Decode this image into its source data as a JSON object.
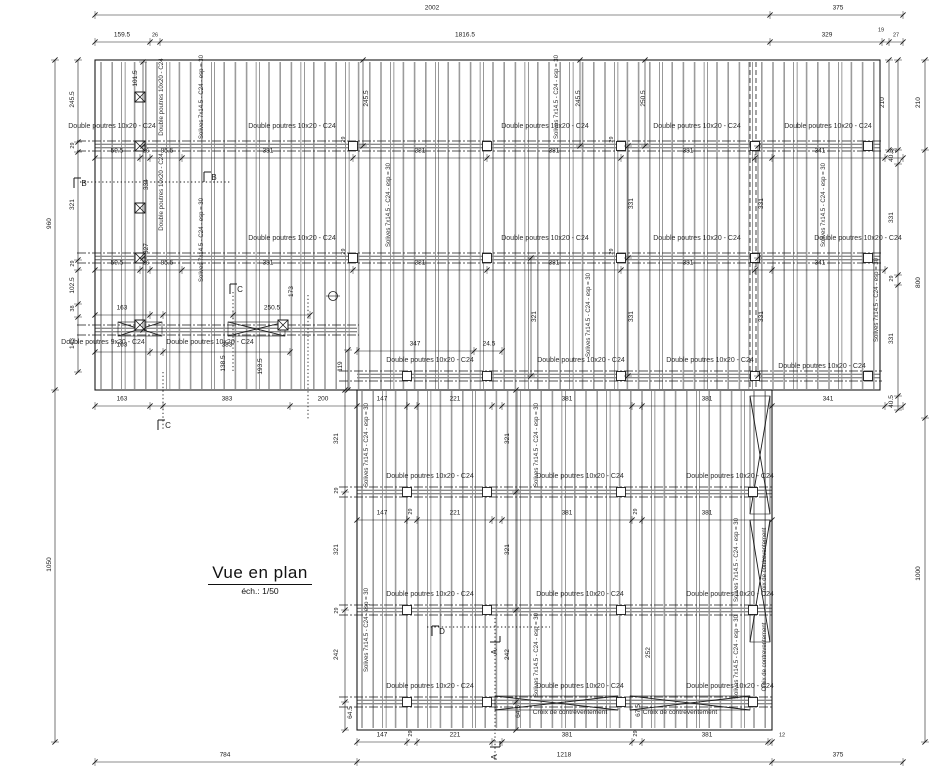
{
  "title": {
    "text": "Vue en plan",
    "scale_note": "éch.: 1/50"
  },
  "colors": {
    "line": "#1a1a1a",
    "joist": "#9c9c9c",
    "joist_dark": "#555555",
    "label": "#2e2e2e",
    "bg": "#ffffff"
  },
  "materials": {
    "double_beam_10x20": "Double poutres 10x20 - C24",
    "double_beam_9x20": "Double poutres 9x20 - C24",
    "joists": "Solives 7x14.5 - C24 - esp = 30",
    "bracing": "Croix de contreventement"
  },
  "section_markers_present": [
    "A",
    "B",
    "C",
    "D"
  ],
  "dimension_summary": {
    "top_row1": [
      "2002",
      "375"
    ],
    "top_row2": [
      "159.5",
      "26",
      "1816.5",
      "329",
      "19",
      "27"
    ],
    "bottom_row": [
      "784",
      "1218",
      "375"
    ],
    "left_outer": [
      "960",
      "1050"
    ],
    "left_inner": [
      "245.5",
      "29",
      "321",
      "29",
      "102.5",
      "38",
      "143"
    ],
    "right_outer": [
      "210",
      "800",
      "1000"
    ],
    "right_inner": [
      "210",
      "40.5",
      "331",
      "29",
      "331",
      "40.5"
    ]
  },
  "drawing": {
    "size": {
      "w": 937,
      "h": 779
    },
    "outlines": [
      [
        95,
        60,
        785,
        330
      ],
      [
        357,
        390,
        415,
        340
      ]
    ],
    "joist_fields": [
      {
        "x1": 101,
        "x2": 874,
        "y1": 62,
        "y2": 389,
        "sp": 11.2
      },
      {
        "x1": 362,
        "x2": 768,
        "y1": 391,
        "y2": 728,
        "sp": 11.2
      }
    ],
    "beam_bands": [
      {
        "y": 146,
        "x1": 95,
        "x2": 880
      },
      {
        "y": 258,
        "x1": 95,
        "x2": 880
      },
      {
        "y": 330,
        "x1": 95,
        "x2": 357
      },
      {
        "y": 376,
        "x1": 357,
        "x2": 880
      },
      {
        "y": 492,
        "x1": 357,
        "x2": 772
      },
      {
        "y": 610,
        "x1": 357,
        "x2": 772
      },
      {
        "y": 702,
        "x1": 357,
        "x2": 772
      }
    ],
    "posts": [
      [
        353,
        146
      ],
      [
        487,
        146
      ],
      [
        621,
        146
      ],
      [
        755,
        146
      ],
      [
        868,
        146
      ],
      [
        353,
        258
      ],
      [
        487,
        258
      ],
      [
        621,
        258
      ],
      [
        755,
        258
      ],
      [
        868,
        258
      ],
      [
        407,
        376
      ],
      [
        487,
        376
      ],
      [
        621,
        376
      ],
      [
        755,
        376
      ],
      [
        868,
        376
      ],
      [
        407,
        492
      ],
      [
        487,
        492
      ],
      [
        621,
        492
      ],
      [
        753,
        492
      ],
      [
        407,
        610
      ],
      [
        487,
        610
      ],
      [
        621,
        610
      ],
      [
        753,
        610
      ],
      [
        407,
        702
      ],
      [
        487,
        702
      ],
      [
        621,
        702
      ],
      [
        753,
        702
      ]
    ],
    "hatched_posts": [
      [
        140,
        97
      ],
      [
        140,
        146
      ],
      [
        140,
        208
      ],
      [
        140,
        258
      ],
      [
        140,
        325
      ],
      [
        283,
        325
      ]
    ],
    "x_braces": [
      [
        750,
        396,
        770,
        514
      ],
      [
        750,
        520,
        770,
        642
      ],
      [
        495,
        696,
        618,
        710
      ],
      [
        630,
        696,
        750,
        710
      ],
      [
        118,
        322,
        162,
        336
      ],
      [
        228,
        322,
        285,
        336
      ]
    ],
    "dashed_members": [
      [
        750,
        62,
        750,
        390
      ],
      [
        756,
        62,
        756,
        390
      ]
    ],
    "dotted_lines": [
      [
        80,
        182,
        230,
        182
      ],
      [
        233,
        292,
        233,
        372
      ],
      [
        163,
        372,
        163,
        430
      ],
      [
        495,
        618,
        495,
        760
      ],
      [
        427,
        627,
        550,
        627
      ],
      [
        308,
        295,
        308,
        420
      ]
    ],
    "detail_circle": [
      333,
      296
    ],
    "dim_rows": [
      [
        15,
        [
          95,
          770,
          903
        ]
      ],
      [
        42,
        [
          95,
          150,
          160,
          770,
          882,
          889,
          903
        ]
      ],
      [
        158,
        [
          95,
          140,
          150,
          182,
          353,
          487,
          621,
          755,
          772,
          885,
          903
        ]
      ],
      [
        270,
        [
          95,
          140,
          150,
          182,
          353,
          487,
          621,
          755,
          772,
          885
        ]
      ],
      [
        315,
        [
          95,
          150,
          163,
          233,
          310
        ]
      ],
      [
        352,
        [
          95,
          150,
          163,
          290
        ]
      ],
      [
        351,
        [
          357,
          474,
          502
        ]
      ],
      [
        406,
        [
          95,
          150,
          163,
          290,
          357,
          407,
          417,
          492,
          502,
          632,
          642,
          772,
          885,
          903
        ]
      ],
      [
        520,
        [
          357,
          407,
          417,
          492,
          502,
          632,
          642,
          772
        ]
      ],
      [
        742,
        [
          357,
          407,
          417,
          492,
          502,
          632,
          642,
          768,
          772
        ]
      ],
      [
        762,
        [
          95,
          357,
          772,
          903
        ]
      ]
    ],
    "dim_cols": [
      [
        55,
        [
          60,
          390,
          742
        ]
      ],
      [
        78,
        [
          60,
          142,
          152,
          260,
          270,
          304,
          317,
          372
        ]
      ],
      [
        143,
        [
          62,
          146,
          258,
          330
        ]
      ],
      [
        363,
        [
          60,
          146
        ]
      ],
      [
        580,
        [
          60,
          146
        ]
      ],
      [
        645,
        [
          60,
          146
        ]
      ],
      [
        531,
        [
          258,
          376
        ]
      ],
      [
        628,
        [
          146,
          258,
          376
        ]
      ],
      [
        758,
        [
          146,
          258,
          376
        ]
      ],
      [
        345,
        [
          390,
          492,
          610,
          702,
          730
        ]
      ],
      [
        516,
        [
          390,
          492,
          610,
          702,
          730
        ]
      ],
      [
        348,
        [
          350,
          390
        ]
      ],
      [
        889,
        [
          60,
          150
        ]
      ],
      [
        898,
        [
          60,
          150,
          164,
          275,
          285,
          396,
          410
        ]
      ],
      [
        925,
        [
          60,
          150,
          418,
          742
        ]
      ]
    ],
    "dim_texts": [
      [
        "2002",
        432,
        11,
        0
      ],
      [
        "375",
        838,
        11,
        0
      ],
      [
        "159.5",
        122,
        38,
        0
      ],
      [
        "26",
        155,
        38,
        0
      ],
      [
        "1816.5",
        465,
        38,
        0
      ],
      [
        "329",
        827,
        38,
        0
      ],
      [
        "19",
        881,
        33,
        0
      ],
      [
        "27",
        896,
        38,
        0
      ],
      [
        "59.5",
        117,
        154,
        0
      ],
      [
        "26",
        146,
        154,
        0
      ],
      [
        "85.5",
        167,
        154,
        0
      ],
      [
        "381",
        268,
        154,
        0
      ],
      [
        "381",
        420,
        154,
        0
      ],
      [
        "381",
        554,
        154,
        0
      ],
      [
        "381",
        688,
        154,
        0
      ],
      [
        "341",
        820,
        154,
        0
      ],
      [
        "27",
        894,
        154,
        0
      ],
      [
        "59.5",
        117,
        266,
        0
      ],
      [
        "26",
        146,
        266,
        0
      ],
      [
        "85.5",
        167,
        266,
        0
      ],
      [
        "381",
        268,
        266,
        0
      ],
      [
        "381",
        420,
        266,
        0
      ],
      [
        "381",
        554,
        266,
        0
      ],
      [
        "381",
        688,
        266,
        0
      ],
      [
        "341",
        820,
        266,
        0
      ],
      [
        "163",
        122,
        311,
        0
      ],
      [
        "250.5",
        272,
        311,
        0
      ],
      [
        "163",
        122,
        348,
        0
      ],
      [
        "383",
        227,
        348,
        0
      ],
      [
        "347",
        415,
        347,
        0
      ],
      [
        "24.5",
        489,
        347,
        0
      ],
      [
        "163",
        122,
        402,
        0
      ],
      [
        "383",
        227,
        402,
        0
      ],
      [
        "200",
        323,
        402,
        0
      ],
      [
        "147",
        382,
        402,
        0
      ],
      [
        "221",
        455,
        402,
        0
      ],
      [
        "381",
        567,
        402,
        0
      ],
      [
        "381",
        707,
        402,
        0
      ],
      [
        "341",
        828,
        402,
        0
      ],
      [
        "147",
        382,
        516,
        0
      ],
      [
        "221",
        455,
        516,
        0
      ],
      [
        "381",
        567,
        516,
        0
      ],
      [
        "381",
        707,
        516,
        0
      ],
      [
        "147",
        382,
        738,
        0
      ],
      [
        "221",
        455,
        738,
        0
      ],
      [
        "381",
        567,
        738,
        0
      ],
      [
        "381",
        707,
        738,
        0
      ],
      [
        "12",
        782,
        738,
        0
      ],
      [
        "784",
        225,
        758,
        0
      ],
      [
        "1218",
        564,
        758,
        0
      ],
      [
        "375",
        838,
        758,
        0
      ],
      [
        "960",
        51,
        225,
        1
      ],
      [
        "1050",
        51,
        566,
        1
      ],
      [
        "245.5",
        74,
        101,
        1
      ],
      [
        "29",
        74,
        147,
        1
      ],
      [
        "321",
        74,
        206,
        1
      ],
      [
        "29",
        74,
        265,
        1
      ],
      [
        "102.5",
        74,
        287,
        1
      ],
      [
        "38",
        74,
        310,
        1
      ],
      [
        "143",
        74,
        345,
        1
      ],
      [
        "101.5",
        137,
        80,
        1
      ],
      [
        "334",
        148,
        186,
        1
      ],
      [
        "327",
        148,
        250,
        1
      ],
      [
        "245.5",
        368,
        100,
        1
      ],
      [
        "245.5",
        580,
        100,
        1
      ],
      [
        "250.5",
        645,
        100,
        1
      ],
      [
        "321",
        536,
        318,
        1
      ],
      [
        "331",
        633,
        205,
        1
      ],
      [
        "331",
        633,
        318,
        1
      ],
      [
        "331",
        763,
        205,
        1
      ],
      [
        "331",
        763,
        318,
        1
      ],
      [
        "173",
        293,
        293,
        1
      ],
      [
        "138.5",
        225,
        365,
        1
      ],
      [
        "193.5",
        262,
        368,
        1
      ],
      [
        "119",
        342,
        368,
        1
      ],
      [
        "321",
        338,
        440,
        1
      ],
      [
        "29",
        338,
        492,
        1
      ],
      [
        "321",
        338,
        551,
        1
      ],
      [
        "29",
        338,
        612,
        1
      ],
      [
        "242",
        338,
        656,
        1
      ],
      [
        "64.5",
        352,
        714,
        1
      ],
      [
        "321",
        509,
        440,
        1
      ],
      [
        "321",
        509,
        551,
        1
      ],
      [
        "242",
        509,
        656,
        1
      ],
      [
        "64.5",
        520,
        713,
        1
      ],
      [
        "67.5",
        640,
        712,
        1
      ],
      [
        "252",
        650,
        654,
        1
      ],
      [
        "210",
        884,
        104,
        1
      ],
      [
        "210",
        920,
        104,
        1
      ],
      [
        "40.5",
        893,
        157,
        1
      ],
      [
        "331",
        893,
        219,
        1
      ],
      [
        "29",
        893,
        280,
        1
      ],
      [
        "331",
        893,
        340,
        1
      ],
      [
        "40.5",
        893,
        403,
        1
      ],
      [
        "800",
        920,
        284,
        1
      ],
      [
        "1000",
        920,
        575,
        1
      ],
      [
        "29",
        345,
        141,
        1
      ],
      [
        "29",
        345,
        253,
        1
      ],
      [
        "29",
        613,
        141,
        1
      ],
      [
        "29",
        613,
        253,
        1
      ],
      [
        "29",
        412,
        513,
        1
      ],
      [
        "29",
        637,
        513,
        1
      ],
      [
        "29",
        412,
        735,
        1
      ],
      [
        "29",
        637,
        735,
        1
      ]
    ],
    "labels": {
      "beam_h": [
        [
          112,
          128
        ],
        [
          292,
          128
        ],
        [
          545,
          128
        ],
        [
          697,
          128
        ],
        [
          828,
          128
        ],
        [
          292,
          240
        ],
        [
          545,
          240
        ],
        [
          697,
          240
        ],
        [
          858,
          240
        ],
        [
          210,
          344
        ],
        [
          430,
          362
        ],
        [
          581,
          362
        ],
        [
          710,
          362
        ],
        [
          822,
          368
        ],
        [
          430,
          478
        ],
        [
          580,
          478
        ],
        [
          730,
          478
        ],
        [
          430,
          596
        ],
        [
          580,
          596
        ],
        [
          730,
          596
        ],
        [
          430,
          688
        ],
        [
          580,
          688
        ],
        [
          730,
          688
        ]
      ],
      "beam9_h": [
        [
          103,
          344
        ]
      ],
      "beam_v": [
        [
          163,
          97
        ],
        [
          163,
          192
        ]
      ],
      "joist_v": [
        [
          203,
          97
        ],
        [
          203,
          240
        ],
        [
          390,
          205
        ],
        [
          558,
          97
        ],
        [
          590,
          315
        ],
        [
          825,
          205
        ],
        [
          368,
          445
        ],
        [
          368,
          630
        ],
        [
          538,
          445
        ],
        [
          538,
          655
        ],
        [
          738,
          560
        ],
        [
          738,
          657
        ],
        [
          878,
          300
        ]
      ],
      "brace_h": [
        [
          570,
          714
        ],
        [
          680,
          714
        ]
      ],
      "brace_v": [
        [
          766,
          562
        ],
        [
          766,
          657
        ]
      ]
    },
    "markers": [
      {
        "t": "A",
        "x": 497,
        "y": 652,
        "r": -90
      },
      {
        "t": "A",
        "x": 497,
        "y": 757,
        "r": -90
      },
      {
        "t": "B",
        "x": 84,
        "y": 186,
        "r": 0
      },
      {
        "t": "B",
        "x": 214,
        "y": 180,
        "r": 0
      },
      {
        "t": "C",
        "x": 240,
        "y": 292,
        "r": 0
      },
      {
        "t": "C",
        "x": 168,
        "y": 428,
        "r": 0
      },
      {
        "t": "D",
        "x": 442,
        "y": 634,
        "r": 0
      }
    ]
  }
}
